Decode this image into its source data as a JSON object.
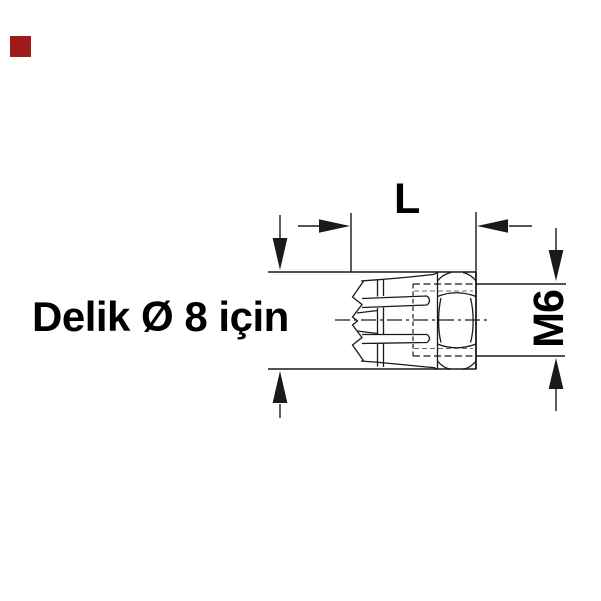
{
  "page": {
    "background_color": "#ffffff"
  },
  "brand_mark": {
    "color": "#9e1b1a"
  },
  "drawing": {
    "line_color": "#1a1a1a",
    "thread_line_color": "#6e6e6e",
    "text_color": "#000000",
    "note_label": "Delik Ø 8 için",
    "length_dimension_label": "L",
    "thread_dimension_label": "M6"
  }
}
